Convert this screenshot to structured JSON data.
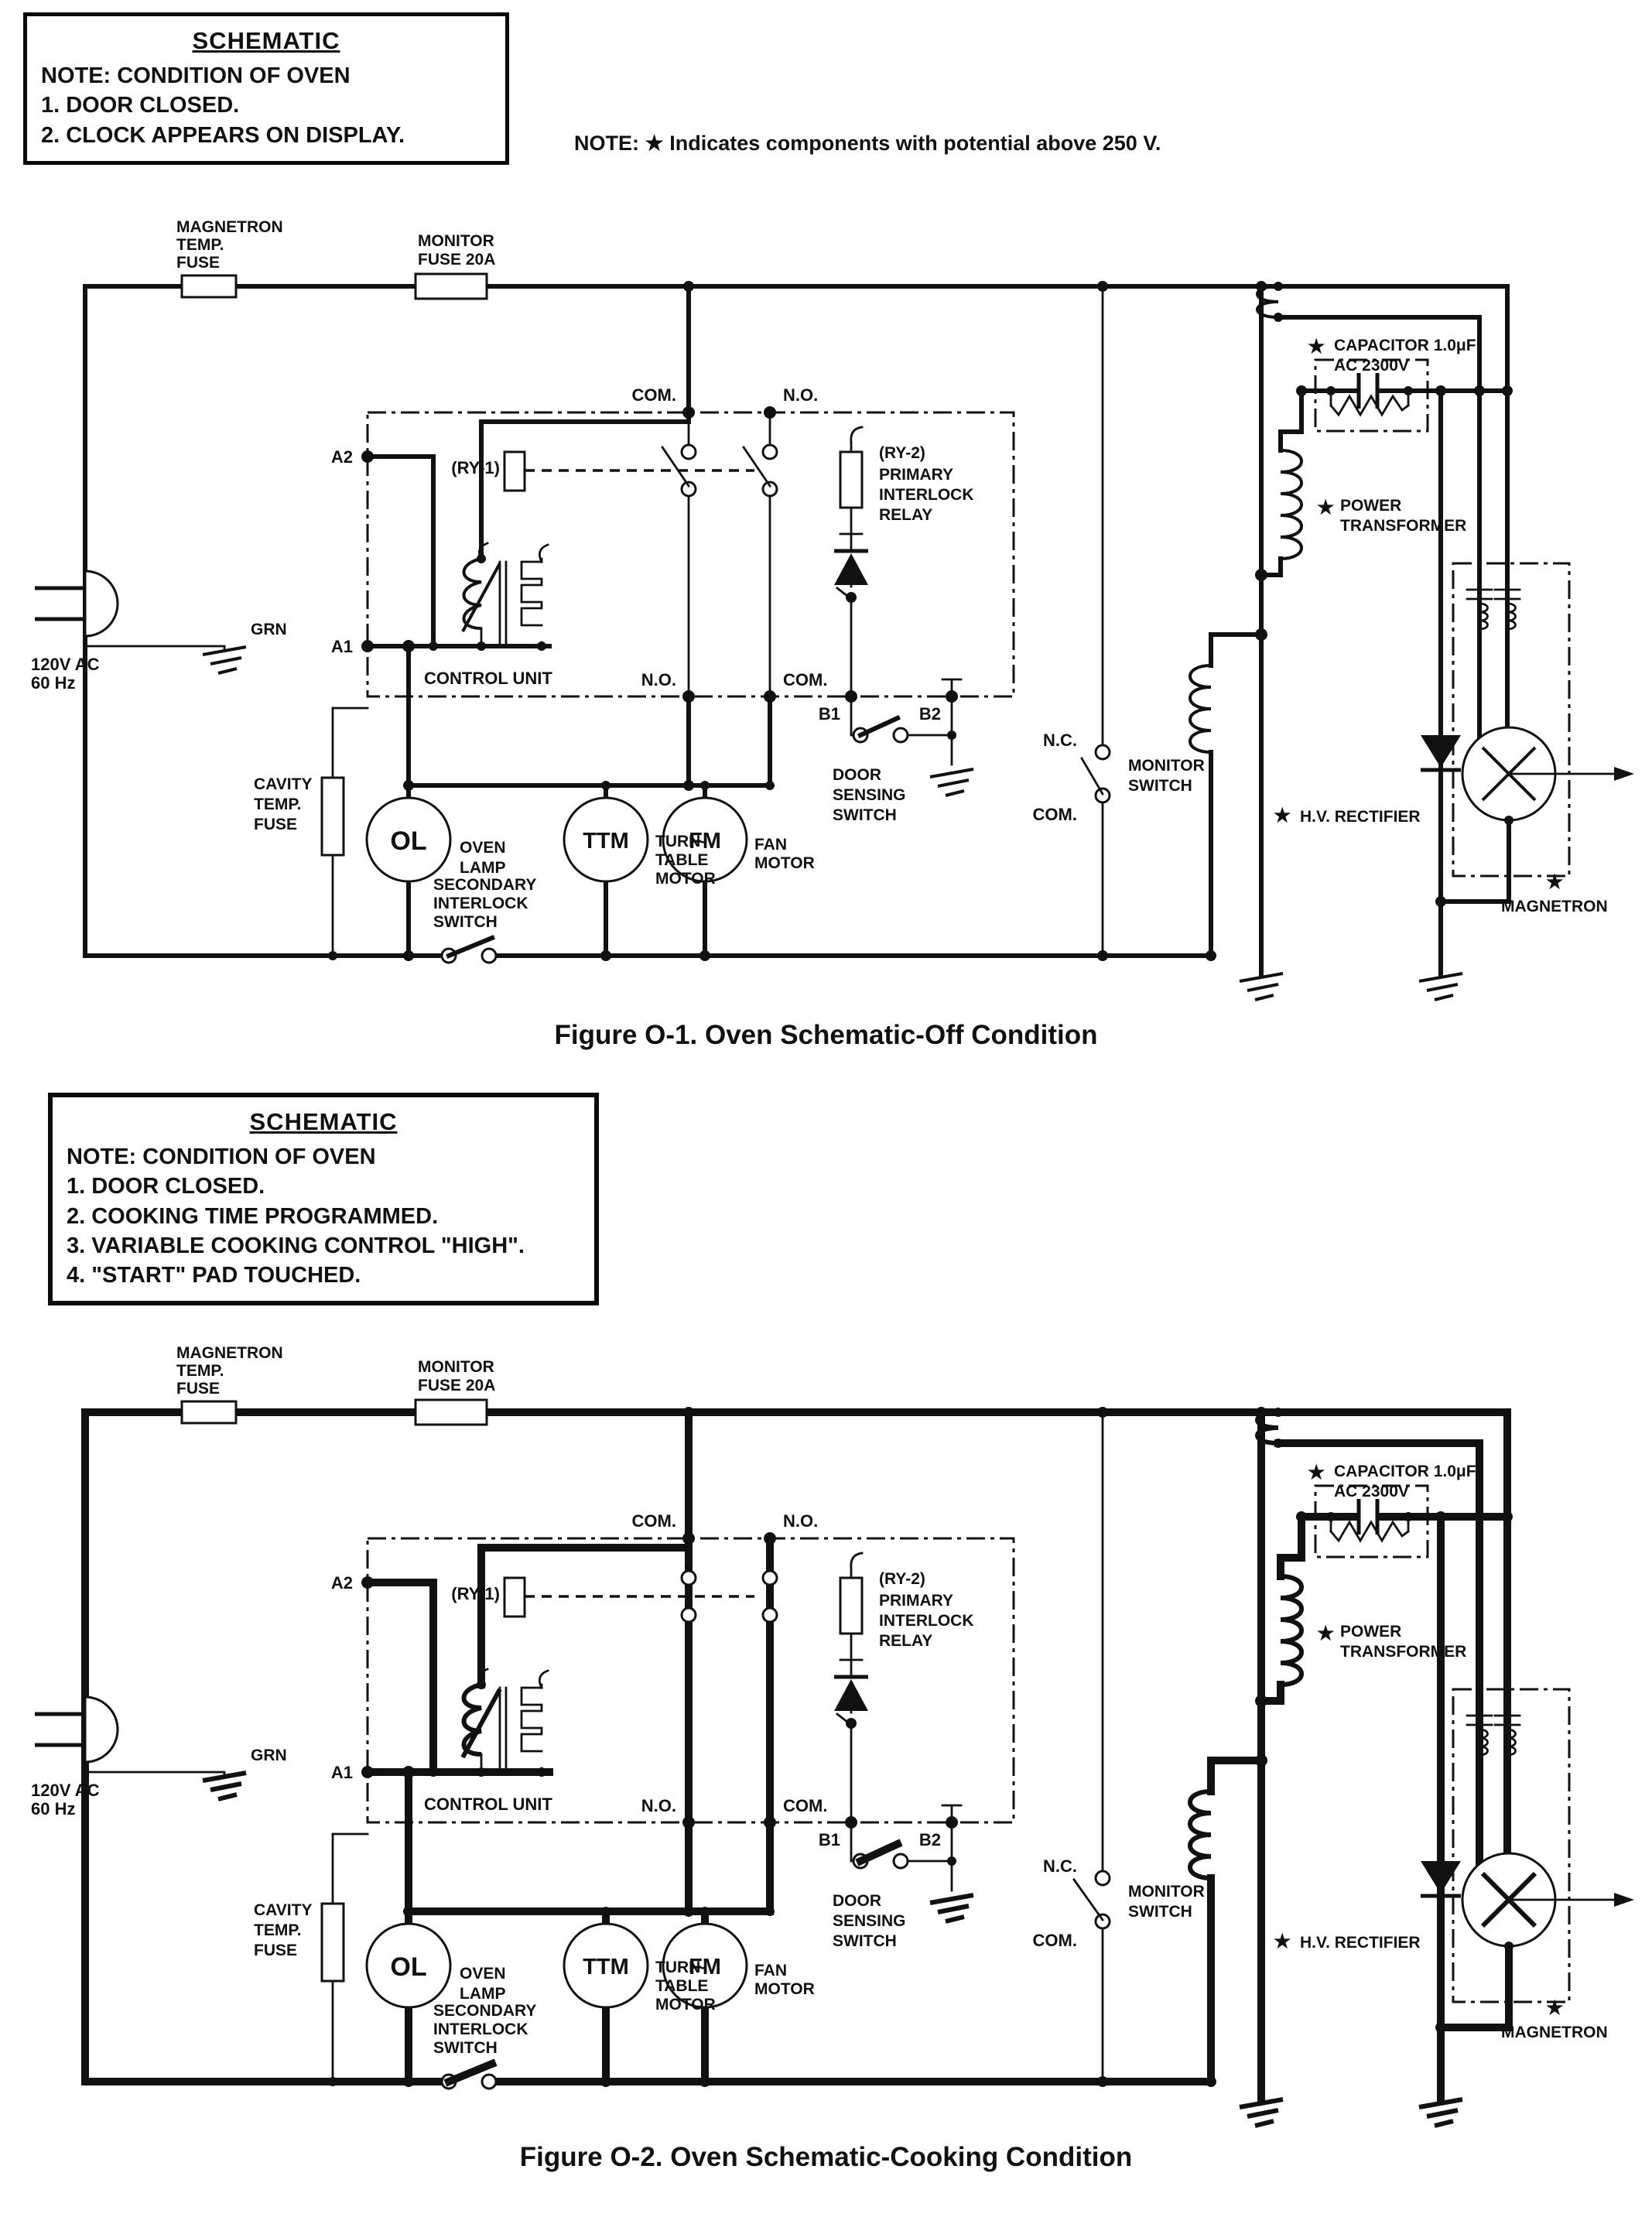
{
  "note_box1": {
    "title": "SCHEMATIC",
    "lines": [
      "NOTE: CONDITION OF OVEN",
      "1.  DOOR CLOSED.",
      "2.  CLOCK APPEARS ON DISPLAY."
    ]
  },
  "hv_note": "NOTE: ★ Indicates components with potential above 250 V.",
  "caption_off": "Figure O-1. Oven Schematic-Off Condition",
  "note_box2": {
    "title": "SCHEMATIC",
    "lines": [
      "NOTE: CONDITION OF OVEN",
      "1.  DOOR CLOSED.",
      "2.  COOKING TIME PROGRAMMED.",
      "3.  VARIABLE COOKING CONTROL \"HIGH\".",
      "4.  \"START\" PAD TOUCHED."
    ]
  },
  "caption_cooking": "Figure O-2. Oven Schematic-Cooking Condition",
  "star": "★",
  "sch": {
    "magnetron_fuse": [
      "MAGNETRON",
      "TEMP.",
      "FUSE"
    ],
    "monitor_fuse": [
      "MONITOR",
      "FUSE 20A"
    ],
    "com": "COM.",
    "no": "N.O.",
    "nc": "N.C.",
    "a2": "A2",
    "a1": "A1",
    "b1": "B1",
    "b2": "B2",
    "ry1": "(RY-1)",
    "ry2": [
      "(RY-2)",
      "PRIMARY",
      "INTERLOCK",
      "RELAY"
    ],
    "control_unit": "CONTROL UNIT",
    "door_switch": [
      "DOOR",
      "SENSING",
      "SWITCH"
    ],
    "monitor_switch": [
      "MONITOR",
      "SWITCH"
    ],
    "supply": [
      "120V AC",
      "60 Hz"
    ],
    "grn": "GRN",
    "cavity_fuse": [
      "CAVITY",
      "TEMP.",
      "FUSE"
    ],
    "oven_lamp_abbr": "OL",
    "ttm_abbr": "TTM",
    "fm_abbr": "FM",
    "oven_lamp": [
      "OVEN",
      "LAMP"
    ],
    "turntable": [
      "TURN-",
      "TABLE",
      "MOTOR"
    ],
    "fan": [
      "FAN",
      "MOTOR"
    ],
    "secondary_interlock": [
      "SECONDARY",
      "INTERLOCK",
      "SWITCH"
    ],
    "capacitor": [
      "CAPACITOR 1.0μF",
      "AC 2300V"
    ],
    "power_transformer": [
      "POWER",
      "TRANSFORMER"
    ],
    "hv_rectifier": "H.V. RECTIFIER",
    "magnetron": "MAGNETRON"
  }
}
